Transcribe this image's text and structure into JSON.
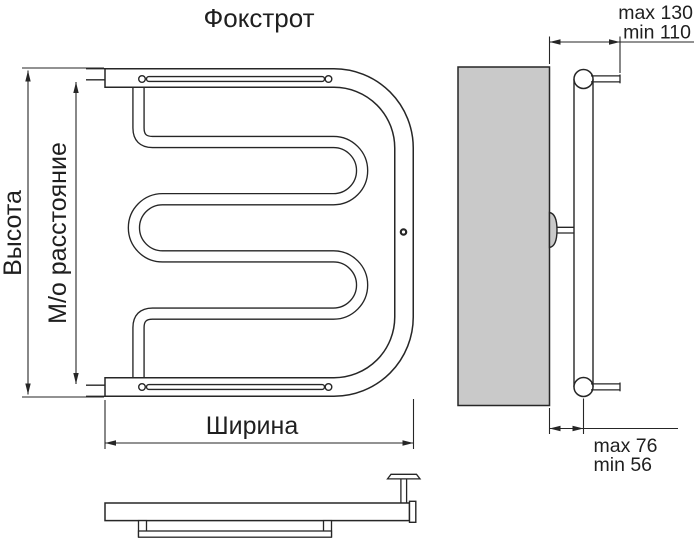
{
  "title": "Фокстрот",
  "front_view": {
    "height_label": "Высота",
    "center_distance_label": "М/о расстояние",
    "width_label": "Ширина"
  },
  "side_view": {
    "top_wall_offset_max": "max 130",
    "top_wall_offset_min": "min 110",
    "bottom_wall_offset_max": "max 76",
    "bottom_wall_offset_min": "min 56"
  },
  "colors": {
    "line": "#262626",
    "text": "#1f1f1f",
    "wall_fill": "#c9c9c9",
    "background": "#ffffff"
  }
}
